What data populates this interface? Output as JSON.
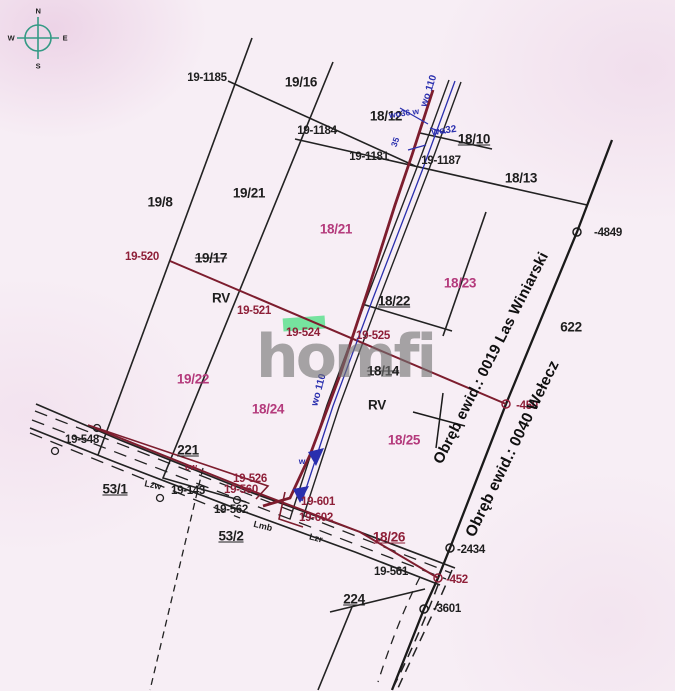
{
  "watermark": "homfi",
  "compass": {
    "n": "N",
    "e": "E",
    "s": "S",
    "w": "W"
  },
  "districts": {
    "winiarski": "Obręb ewid.: 0019 Las Winiarski",
    "welecz": "Obręb ewid.: 0040 Wełecz"
  },
  "labels": {
    "p19_1185": "19-1185",
    "p19_16": "19/16",
    "p19_1184": "19-1184",
    "p18_12": "18/12",
    "p18_10": "18/10",
    "p19_1181": "19-1181",
    "p19_1187": "19-1187",
    "p18_13": "18/13",
    "p19_8": "19/8",
    "p19_21": "19/21",
    "p18_21": "18/21",
    "p19_520": "19-520",
    "p19_17": "19/17",
    "rv_west": "RV",
    "p19_521": "19-521",
    "p18_23": "18/23",
    "p18_22": "18/22",
    "n622": "622",
    "p19_524": "19-524",
    "p19_525": "19-525",
    "p18_14": "18/14",
    "p19_22": "19/22",
    "p18_24": "18/24",
    "rv_east": "RV",
    "p18_25": "18/25",
    "m4849": "-4849",
    "m450": "-450",
    "m2434": "-2434",
    "m452": "-452",
    "m3601": "-3601",
    "p19_548": "19-548",
    "n221": "221",
    "ew": "ew",
    "p53_1": "53/1",
    "p19_143": "19-143",
    "p19_562": "19-562",
    "p53_2": "53/2",
    "p19_526": "19-526",
    "p19_560": "19-560",
    "p19_601": "19-601",
    "p19_602": "19-602",
    "p18_26": "18/26",
    "p19_561": "19-561",
    "n224": "224",
    "lmb": "Lmb",
    "lzr": "Lzr",
    "lzw": "Lzw",
    "wo110_top": "wo 110",
    "wo36": "wo36 w",
    "wo32": "wo32",
    "b35": "35",
    "wo110_mid": "wo 110",
    "bw": "w"
  },
  "colors": {
    "background": "#f7eef5",
    "linework": "#222222",
    "boundary_red": "#7d1d2e",
    "marker_maroon": "#8e1f38",
    "parcel_pink": "#b43a7c",
    "utility_blue": "#2a2fae",
    "highlight_green": "#5fe08f",
    "compass_teal": "#359a85",
    "watermark_gray": "#737373"
  }
}
